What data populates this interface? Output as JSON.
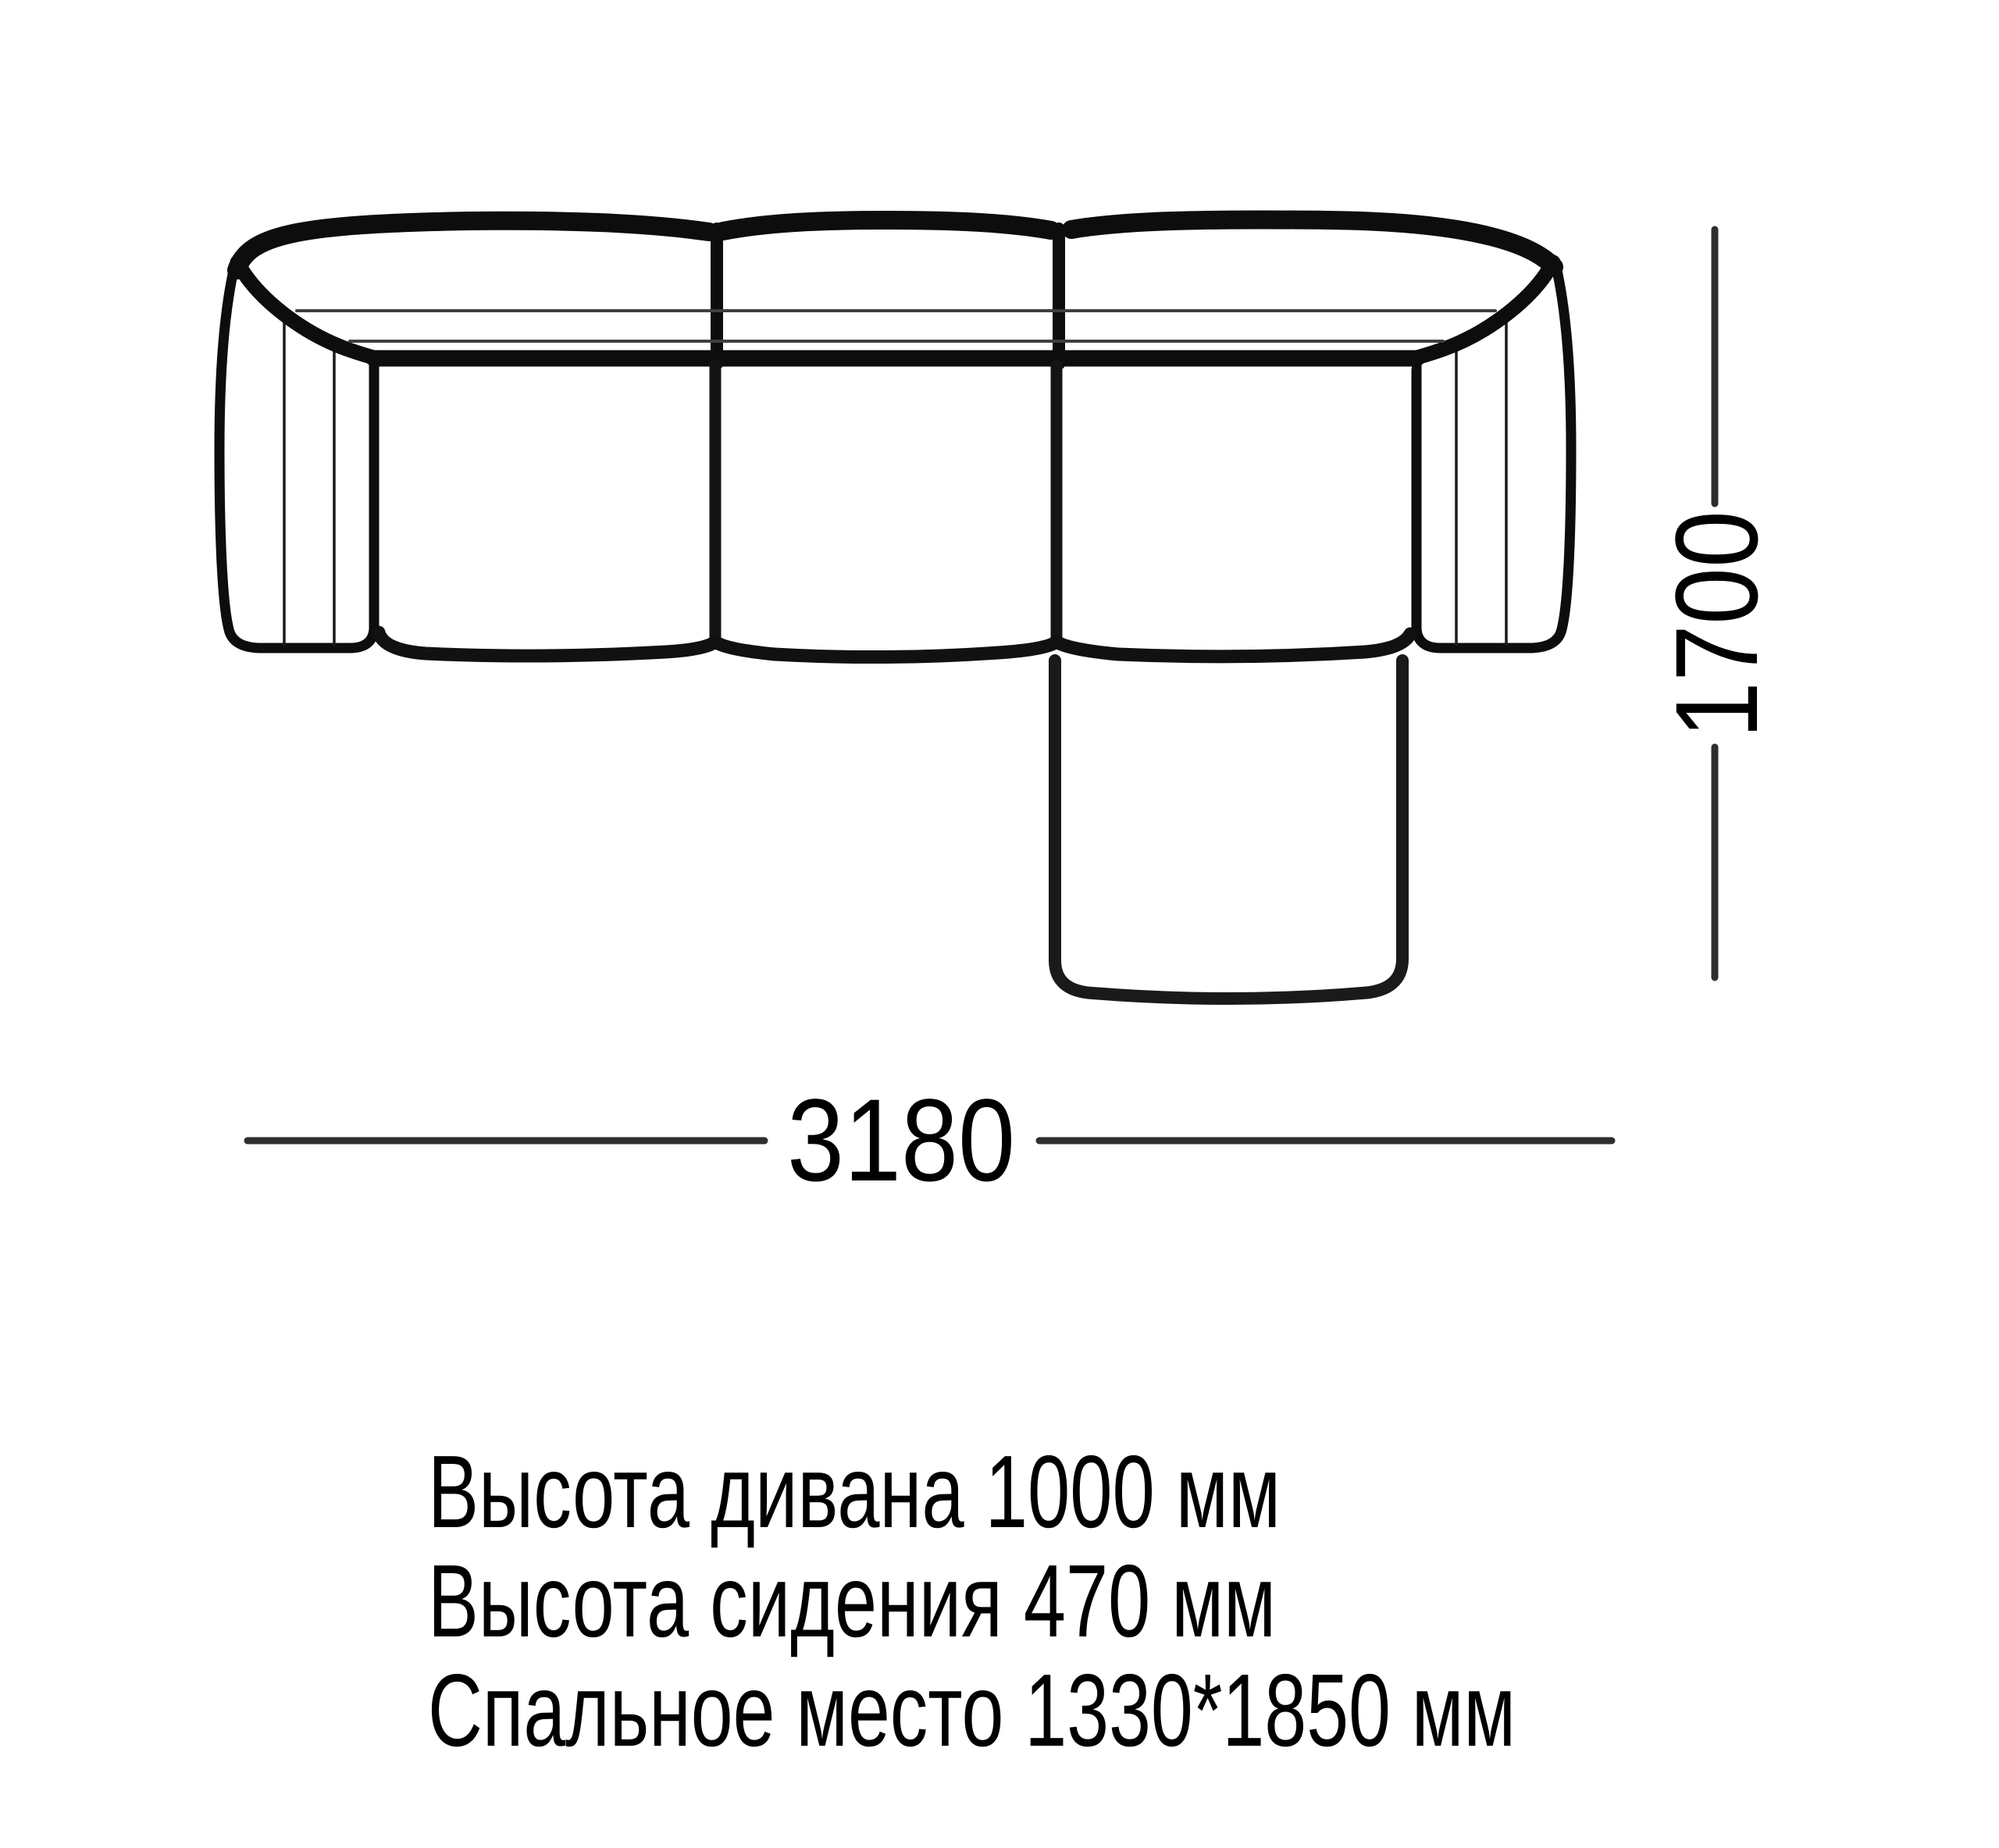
{
  "diagram": {
    "type": "sofa-top-view-dimension-drawing",
    "width_label": "3180",
    "depth_label": "1700",
    "specs": [
      "Высота дивана 1000 мм",
      "Высота сидения 470 мм",
      "Спальное место 1330*1850 мм"
    ]
  },
  "colors": {
    "background": "#ffffff",
    "outline": "#0d0d0d",
    "seam": "#3f3f3f",
    "dimension": "#2e2e2e",
    "text": "#000000"
  }
}
